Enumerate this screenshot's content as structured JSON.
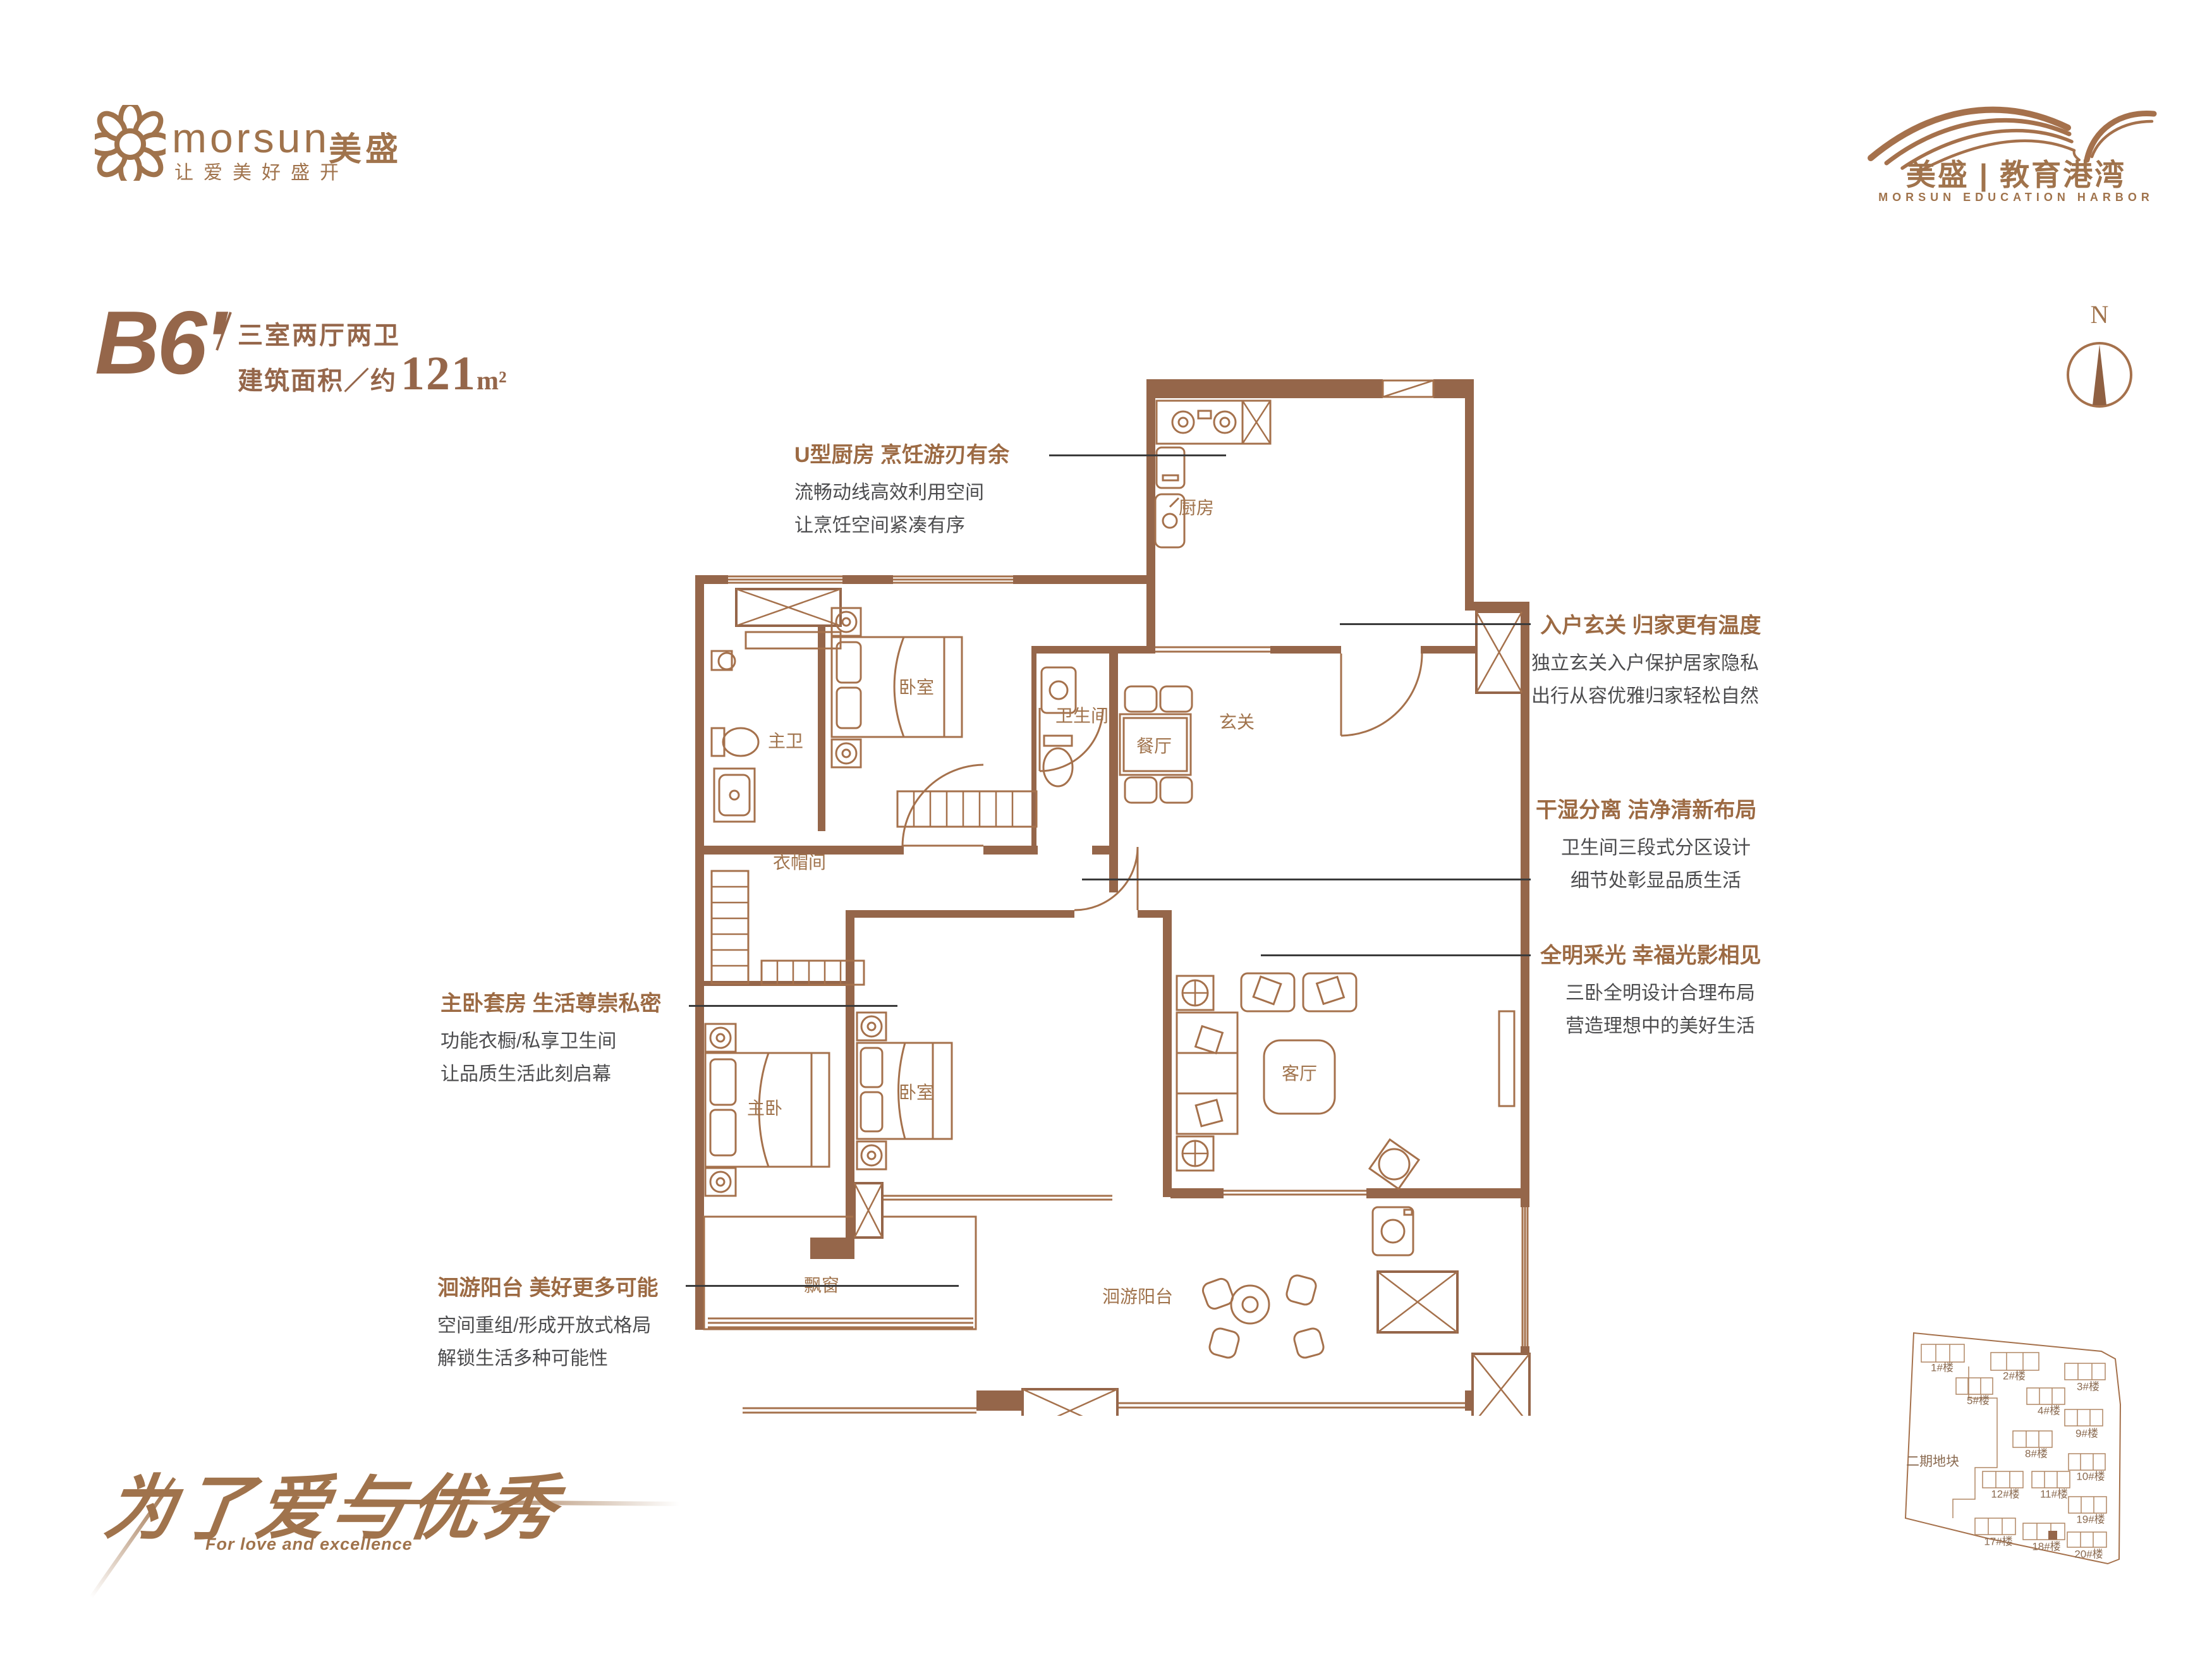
{
  "brand": {
    "name": "morsun",
    "name_cn": "美盛",
    "tagline": "让爱美好盛开"
  },
  "project": {
    "name": "美盛 | 教育港湾",
    "name_en": "MORSUN EDUCATION HARBOR"
  },
  "unit": {
    "code": "B6'",
    "layout": "三室两厅两卫",
    "area_label": "建筑面积／约",
    "area_value": "121",
    "area_unit": "m²"
  },
  "compass": {
    "north_label": "N"
  },
  "rooms": {
    "kitchen": "厨房",
    "bath": "卫生间",
    "dining": "餐厅",
    "foyer": "玄关",
    "master_bath": "主卫",
    "bedroom_a": "卧室",
    "cloak": "衣帽间",
    "master": "主卧",
    "bedroom_b": "卧室",
    "living": "客厅",
    "bay": "飘窗",
    "balcony": "洄游阳台"
  },
  "annotations": {
    "kitchen": {
      "title": "U型厨房 烹饪游刃有余",
      "line1": "流畅动线高效利用空间",
      "line2": "让烹饪空间紧凑有序"
    },
    "foyer": {
      "title": "入户玄关 归家更有温度",
      "line1": "独立玄关入户保护居家隐私",
      "line2": "出行从容优雅归家轻松自然"
    },
    "dry_wet": {
      "title": "干湿分离 洁净清新布局",
      "line1": "卫生间三段式分区设计",
      "line2": "细节处彰显品质生活"
    },
    "daylight": {
      "title": "全明采光 幸福光影相见",
      "line1": "三卧全明设计合理布局",
      "line2": "营造理想中的美好生活"
    },
    "master": {
      "title": "主卧套房 生活尊崇私密",
      "line1": "功能衣橱/私享卫生间",
      "line2": "让品质生活此刻启幕"
    },
    "balcony": {
      "title": "洄游阳台 美好更多可能",
      "line1": "空间重组/形成开放式格局",
      "line2": "解锁生活多种可能性"
    }
  },
  "slogan": {
    "cn": "为了爱与优秀",
    "en": "For love and excellence"
  },
  "siteplan": {
    "phase_label": "二期地块",
    "buildings": [
      {
        "label": "1#楼"
      },
      {
        "label": "2#楼"
      },
      {
        "label": "3#楼"
      },
      {
        "label": "5#楼"
      },
      {
        "label": "4#楼"
      },
      {
        "label": "9#楼"
      },
      {
        "label": "8#楼"
      },
      {
        "label": "10#楼"
      },
      {
        "label": "12#楼"
      },
      {
        "label": "11#楼"
      },
      {
        "label": "19#楼"
      },
      {
        "label": "17#楼"
      },
      {
        "label": "18#楼"
      },
      {
        "label": "20#楼"
      }
    ],
    "highlighted_building": "18#楼"
  },
  "colors": {
    "brand_brown": "#a0734c",
    "wall_brown": "#95664a",
    "plan_line_brown": "#a5714c",
    "text_gray": "#4c4c4e",
    "leader_line": "#3b3b3b"
  }
}
